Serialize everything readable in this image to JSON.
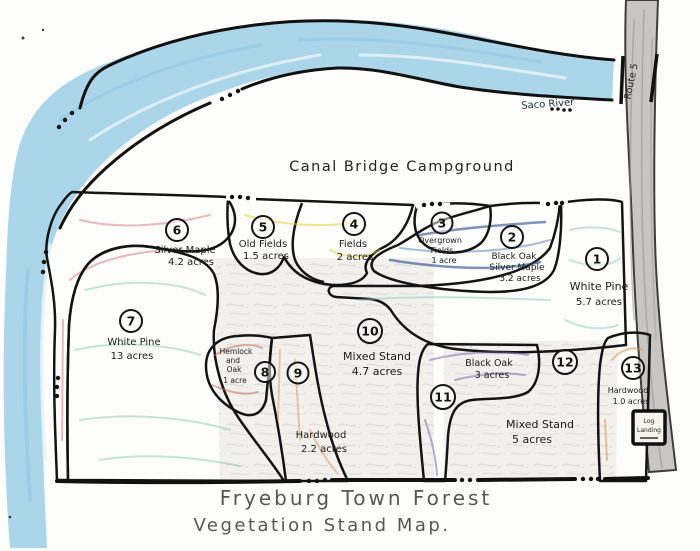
{
  "map": {
    "title_line1": "Fryeburg Town Forest",
    "title_line2": "Vegetation Stand Map.",
    "campground_label": "Canal Bridge Campground",
    "river_label": "Saco River",
    "road_label": "Route 5",
    "log_landing_line1": "Log",
    "log_landing_line2": "Landing"
  },
  "colors": {
    "river": "#abd6ea",
    "road": "#c7c6c4",
    "outline": "#141414"
  },
  "stands": [
    {
      "id": "1",
      "name_lines": [
        "White Pine"
      ],
      "acres": "5.7 acres",
      "color": "#c2e2df"
    },
    {
      "id": "2",
      "name_lines": [
        "Black Oak",
        "Silver Maple"
      ],
      "acres": "3.2 acres",
      "color": "#3e63ab"
    },
    {
      "id": "3",
      "name_lines": [
        "Overgrown",
        "Fields"
      ],
      "acres": "1 acre",
      "color": "#f7f0a8"
    },
    {
      "id": "4",
      "name_lines": [
        "Fields"
      ],
      "acres": "2 acres",
      "color": "#f5e042"
    },
    {
      "id": "5",
      "name_lines": [
        "Old Fields"
      ],
      "acres": "1.5 acres",
      "color": "#f5e042"
    },
    {
      "id": "6",
      "name_lines": [
        "Silver Maple"
      ],
      "acres": "4.2 acres",
      "color": "#eb9fa6"
    },
    {
      "id": "7",
      "name_lines": [
        "White Pine"
      ],
      "acres": "13 acres",
      "color": "#b9ddd2"
    },
    {
      "id": "8",
      "name_lines": [
        "Hemlock",
        "and",
        "Oak"
      ],
      "acres": "1 acre",
      "color": "#dc9a88"
    },
    {
      "id": "9",
      "name_lines": [
        "Hardwood"
      ],
      "acres": "2.2 acres",
      "color": "#efb67a"
    },
    {
      "id": "10",
      "name_lines": [
        "Mixed Stand"
      ],
      "acres": "4.7 acres",
      "color": "#f2f1ee"
    },
    {
      "id": "11",
      "name_lines": [
        "Black Oak"
      ],
      "acres": "3 acres",
      "color": "#9186c4"
    },
    {
      "id": "12",
      "name_lines": [
        "Mixed Stand"
      ],
      "acres": "5 acres",
      "color": "#f2f1ee"
    },
    {
      "id": "13",
      "name_lines": [
        "Hardwood"
      ],
      "acres": "1.0 acres",
      "color": "#efa968"
    }
  ]
}
